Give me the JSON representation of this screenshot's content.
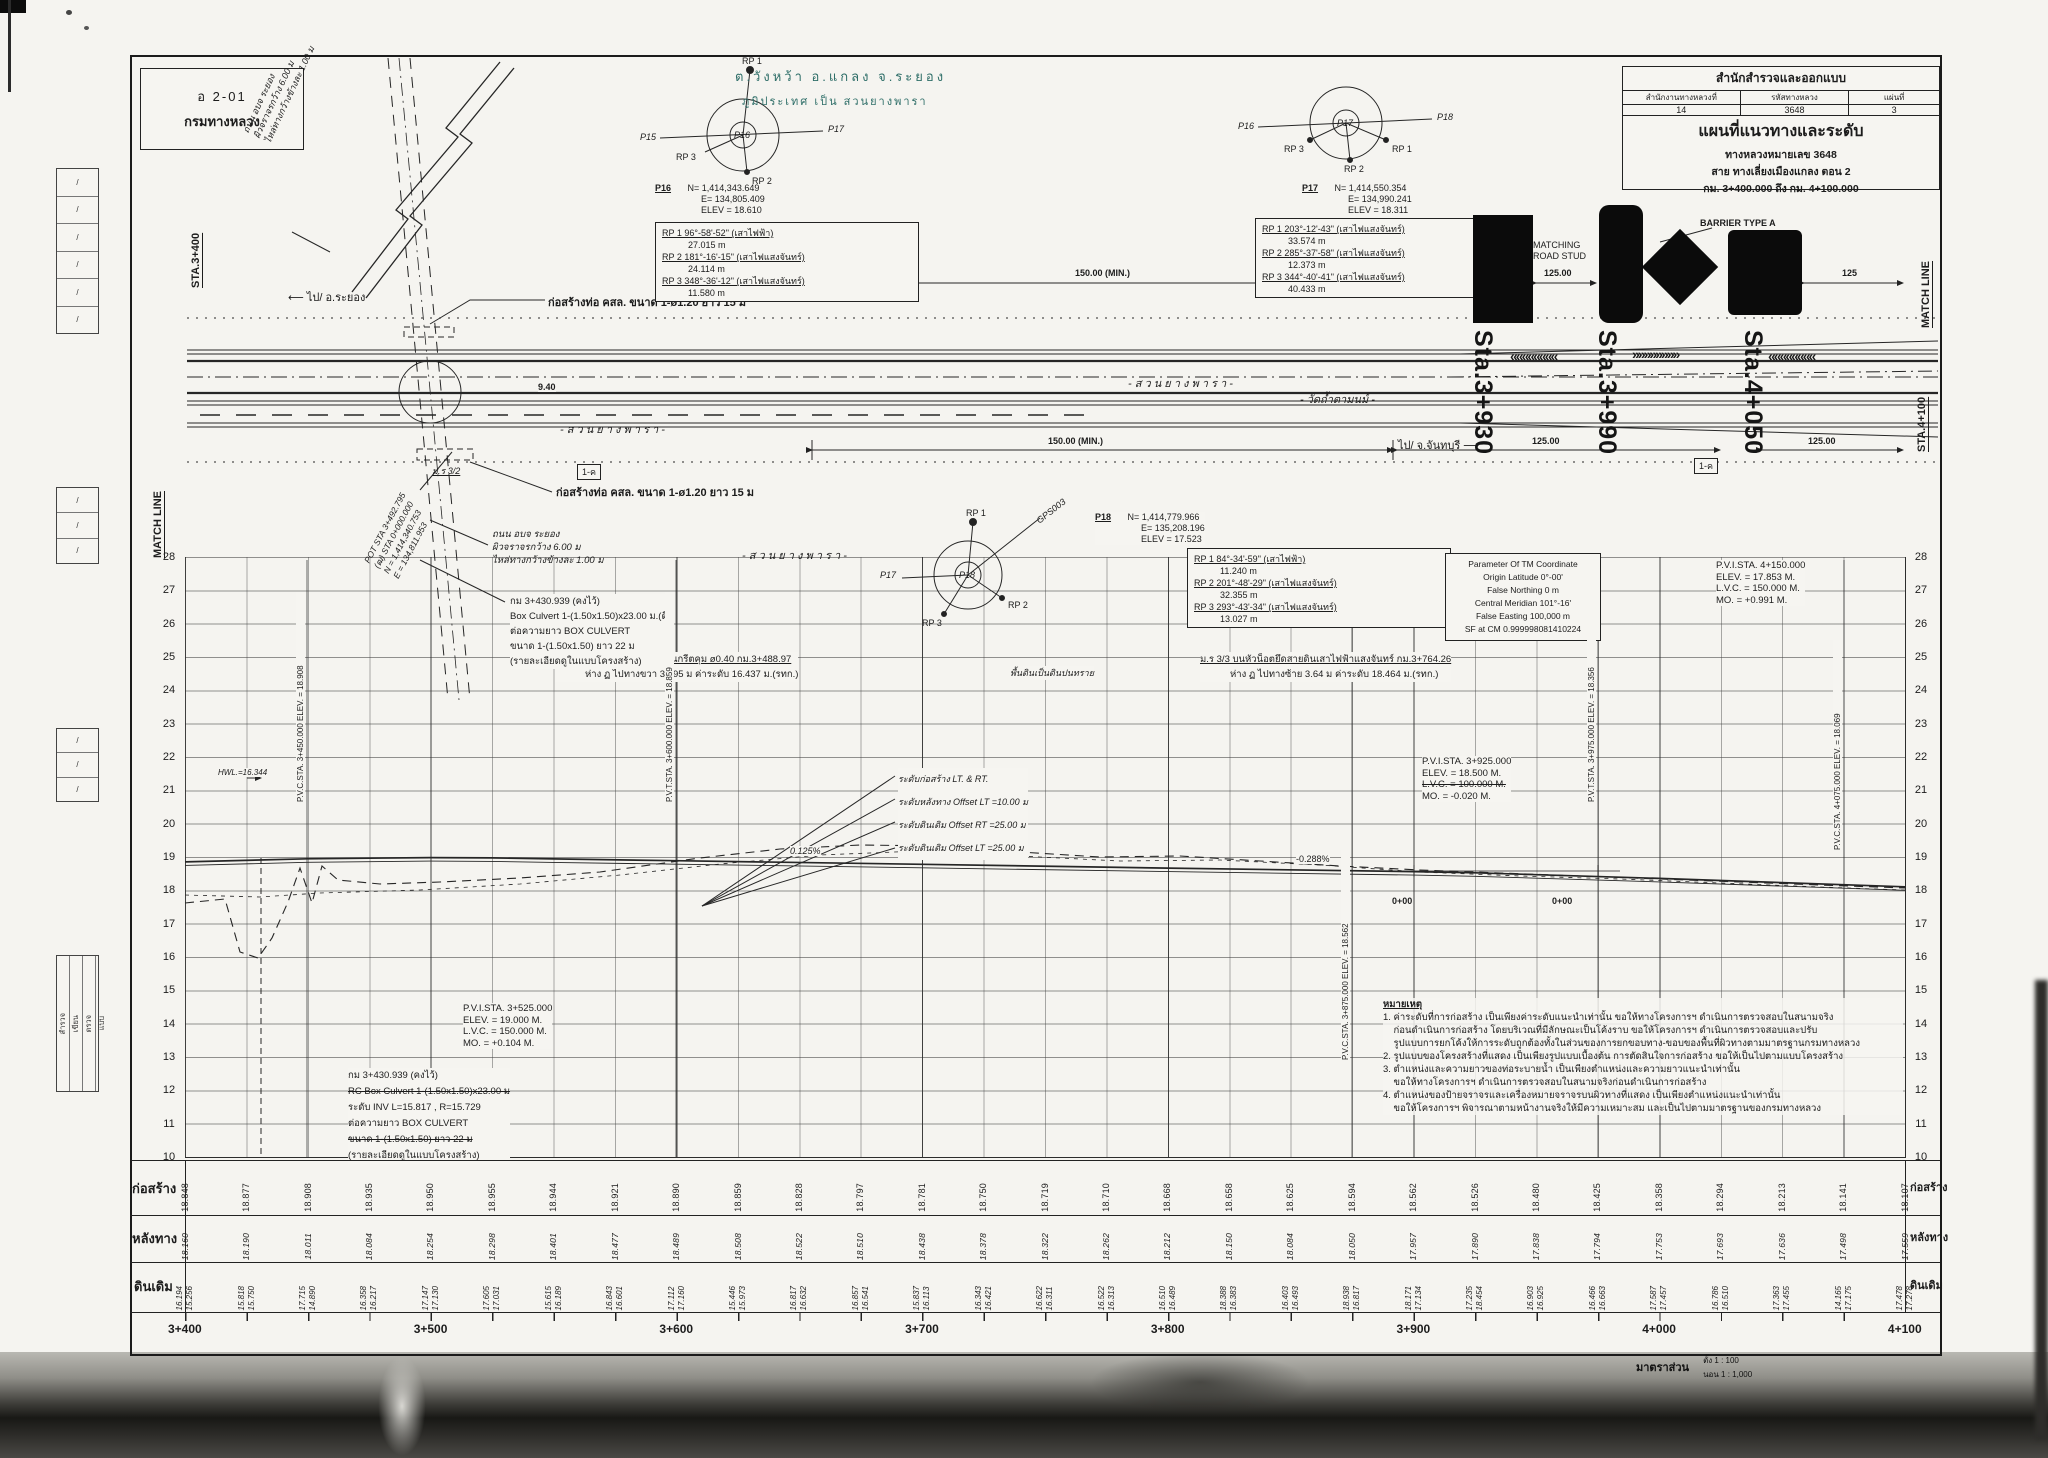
{
  "stamp": {
    "code": "อ 2-01",
    "org": "กรมทางหลวง"
  },
  "title_block": {
    "bureau": "สำนักสำรวจและออกแบบ",
    "col1": "สำนักงานทางหลวงที่",
    "col2": "รหัสทางหลวง",
    "col3": "แผ่นที่",
    "val1": "14",
    "val2": "3648",
    "val3": "3",
    "title": "แผนที่แนวทางและระดับ",
    "road": "ทางหลวงหมายเลข 3648",
    "section": "สาย ทางเลี่ยงเมืองแกลง ตอน 2",
    "km_range": "กม. 3+400.000 ถึง กม. 4+100.000"
  },
  "location": {
    "line1": "ต.วังหว้า อ.แกลง จ.ระยอง",
    "line2": "ภูมิประเทศ เป็น สวนยางพารา",
    "accent": "#2e6e68"
  },
  "plan": {
    "match_line_left": "MATCH LINE",
    "match_line_right": "MATCH LINE",
    "sta_left": "STA.3+400",
    "sta_right": "STA.4+100",
    "dir_left": "ไป/ อ.ระยอง",
    "dir_right": "ไป/ จ.จันทบุรี",
    "pipe_note_top": "ก่อสร้างท่อ คสล. ขนาด 1-ø1.20 ยาว 15 ม",
    "pipe_note_bottom": "ก่อสร้างท่อ คสล. ขนาด 1-ø1.20 ยาว 15 ม",
    "side_road_note": [
      "ถนน อบจ ระยอง",
      "ผิวจราจรกว้าง 6.00 ม",
      "ไหล่ทางกว้างข้างละ 1.00 ม"
    ],
    "side_road_note_rot": [
      "ถนน อบจ ระยอง",
      "ผิวจราจรกว้าง 6.00 ม",
      "ไหล่ทางกว้างข้างละ 1.00 ม"
    ],
    "pot_note": [
      "POT STA 3+492.795",
      "(ฒ) STA 0+000.000",
      "N = 1,414,340.753",
      "E = 134,811.953"
    ],
    "culvert_note": [
      "กม 3+430.939 (คงไว้)",
      "Box Culvert 1-(1.50x1.50)x23.00 ม.(ดี)",
      "ต่อความยาว BOX CULVERT",
      "ขนาด 1-(1.50x1.50) ยาว 22 ม",
      "(รายละเอียดดูในแบบโครงสร้าง)"
    ],
    "bm_label": "ม.ร 3/2",
    "sym1": "1-ค",
    "sym2": "1-ค",
    "dim_940": "9.40",
    "plantation1": "- ส ว น ย า ง พ า ร า -",
    "plantation2": "- ส ว น ย า ง พ า ร า -",
    "plantation3": "- ส ว น ย า ง พ า ร า -",
    "temple": "- วัดถ้ำตามนม์ -",
    "matching": "MATCHING",
    "road_stud": "ROAD STUD",
    "barrier": "BARRIER TYPE A",
    "dim_150_top": "150.00 (MIN.)",
    "dim_125_top": "125.00",
    "dim_125_right": "125",
    "dim_150_bot": "150.00 (MIN.)",
    "dim_125_bot1": "125.00",
    "dim_125_bot2": "125.00",
    "chevrons": [
      "««««««««",
      "»»»»»»»»",
      "««««««««"
    ],
    "sta_overlays": [
      "Sta.3+930",
      "Sta.3+990",
      "Sta.4+050"
    ]
  },
  "p16": {
    "id": "P16",
    "n": "N= 1,414,343.649",
    "e": "E=   134,805.409",
    "elev": "ELEV = 18.610",
    "lbl_left": "P15",
    "lbl_right": "P17",
    "rp1": "RP 1",
    "rp2": "RP 2",
    "rp3": "RP 3",
    "rps": [
      {
        "a": "RP 1 96°-58'-52\" (เสาไฟฟ้า)",
        "d": "27.015 m"
      },
      {
        "a": "RP 2 181°-16'-15\" (เสาไฟแสงจันทร์)",
        "d": "24.114 m"
      },
      {
        "a": "RP 3 348°-36'-12\" (เสาไฟแสงจันทร์)",
        "d": "11.580 m"
      }
    ]
  },
  "p17": {
    "id": "P17",
    "n": "N= 1,414,550.354",
    "e": "E=   134,990.241",
    "elev": "ELEV = 18.311",
    "lbl_left": "P16",
    "lbl_right": "P18",
    "rp1": "RP 1",
    "rp2": "RP 2",
    "rp3": "RP 3",
    "rps": [
      {
        "a": "RP 1 203°-12'-43\" (เสาไฟแสงจันทร์)",
        "d": "33.574 m"
      },
      {
        "a": "RP 2 285°-37'-58\" (เสาไฟแสงจันทร์)",
        "d": "12.373 m"
      },
      {
        "a": "RP 3 344°-40'-41\" (เสาไฟแสงจันทร์)",
        "d": "40.433 m"
      }
    ]
  },
  "p18": {
    "id": "P18",
    "n": "N= 1,414,779.966",
    "e": "E=   135,208.196",
    "elev": "ELEV = 17.523",
    "lbl_left": "P17",
    "gps": "GPS003",
    "rp1": "RP 1",
    "rp2": "RP 2",
    "rp3": "RP 3",
    "rps": [
      {
        "a": "RP 1 84°-34'-59\" (เสาไฟฟ้า)",
        "d": "11.240 m"
      },
      {
        "a": "RP 2 201°-48'-29\" (เสาไฟแสงจันทร์)",
        "d": "32.355 m"
      },
      {
        "a": "RP 3 293°-43'-34\" (เสาไฟแสงจันทร์)",
        "d": "13.027 m"
      }
    ]
  },
  "tm_parameters": [
    "Parameter Of TM Coordinate",
    "Origin Latitude  0°-00'",
    "False Northing  0 m",
    "Central Meridian  101°-16'",
    "False Easting  100,000 m",
    "SF at CM  0.999998081410224"
  ],
  "benchmarks": {
    "bm2_l1": "ม.ร 3/2 บนหัวน็อตสะพานคอนกรีตคุม ø0.40  กม.3+488.97",
    "bm2_l2": "ห่าง ฏ ไปทางขวา 38.95 ม  ค่าระดับ 16.437 ม.(รทก.)",
    "soil": "พื้นดินเป็นดินปนทราย",
    "bm3_l1": "ม.ร 3/3 บนหัวน็อตยึดสายดินเสาไฟฟ้าแสงจันทร์  กม.3+764.26",
    "bm3_l2": "ห่าง ฏ ไปทางซ้าย 3.64 ม  ค่าระดับ 18.464 ม.(รทก.)"
  },
  "profile": {
    "elevations": [
      "28",
      "27",
      "26",
      "25",
      "24",
      "23",
      "22",
      "21",
      "20",
      "19",
      "18",
      "17",
      "16",
      "15",
      "14",
      "13",
      "12",
      "11",
      "10"
    ],
    "pvi1": [
      "P.V.I.STA. 3+525.000",
      "ELEV.  =  19.000   M.",
      "L.V.C.  =  150.000   M.",
      "MO.     =  +0.104   M."
    ],
    "pvi2": [
      "P.V.I.STA. 3+925.000",
      "ELEV.  =  18.500   M.",
      "L.V.C.  =  100.000   M.",
      "MO.     =  -0.020   M."
    ],
    "pvi3": [
      "P.V.I.STA. 4+150.000",
      "ELEV.  =  17.853   M.",
      "L.V.C.  =  150.000   M.",
      "MO.     =  +0.991   M."
    ],
    "vlabels": [
      "P.V.C.STA. 3+450.000   ELEV. = 18.908",
      "P.V.T.STA. 3+600.000   ELEV. = 18.859",
      "P.V.C.STA. 3+875.000   ELEV. = 18.562",
      "P.V.T.STA. 3+975.000   ELEV. = 18.356",
      "P.V.C.STA. 4+075.000   ELEV. = 18.069"
    ],
    "grade1": "0.125%",
    "grade2": "-0.288%",
    "zero1": "0+00",
    "zero2": "0+00",
    "hwl": "HWL.=16.344",
    "offsets": [
      "ระดับก่อสร้าง LT. & RT.",
      "ระดับหลังทาง Offset LT =10.00 ม",
      "ระดับดินเดิม Offset RT =25.00 ม",
      "ระดับดินเดิม Offset LT =25.00 ม"
    ],
    "culvert_note": [
      {
        "txt": "กม 3+430.939 (คงไว้)",
        "strike": ""
      },
      {
        "txt": "RC Box Culvert 1-(1.50x1.50)x23.00 ม",
        "strike": "y"
      },
      {
        "txt": "ระดับ INV L=15.817 , R=15.729",
        "strike": ""
      },
      {
        "txt": "ต่อความยาว BOX CULVERT",
        "strike": ""
      },
      {
        "txt": "ขนาด 1-(1.50x1.50) ยาว 22 ม",
        "strike": "y"
      },
      {
        "txt": "(รายละเอียดดูในแบบโครงสร้าง)",
        "strike": ""
      }
    ]
  },
  "notes": {
    "heading": "หมายเหตุ",
    "lines": [
      "1. ค่าระดับที่การก่อสร้าง เป็นเพียงค่าระดับแนะนำเท่านั้น ขอให้ทางโครงการฯ ดำเนินการตรวจสอบในสนามจริง",
      "    ก่อนดำเนินการก่อสร้าง โดยบริเวณที่มีลักษณะเป็นโค้งราบ ขอให้โครงการฯ ดำเนินการตรวจสอบและปรับ",
      "    รูปแบบการยกโค้งให้การระดับถูกต้องทั้งในส่วนของการยกขอบทาง-ขอบของพื้นที่ผิวทางตามมาตรฐานกรมทางหลวง",
      "2. รูปแบบของโครงสร้างที่แสดง เป็นเพียงรูปแบบเบื้องต้น การตัดสินใจการก่อสร้าง ขอให้เป็นไปตามแบบโครงสร้าง",
      "3. ตำแหน่งและความยาวของท่อระบายน้ำ เป็นเพียงตำแหน่งและความยาวแนะนำเท่านั้น",
      "    ขอให้ทางโครงการฯ ดำเนินการตรวจสอบในสนามจริงก่อนดำเนินการก่อสร้าง",
      "4. ตำแหน่งของป้ายจราจรและเครื่องหมายจราจรบนผิวทางที่แสดง เป็นเพียงตำแหน่งแนะนำเท่านั้น",
      "    ขอให้โครงการฯ พิจารณาตามหน้างานจริงให้มีความเหมาะสม และเป็นไปตามมาตรฐานของกรมทางหลวง"
    ]
  },
  "rows": {
    "label_construction": "ก่อสร้าง",
    "label_back": "หลังทาง",
    "label_ground": "ดินเดิม",
    "construction": [
      "18.848",
      "18.877",
      "18.908",
      "18.935",
      "18.950",
      "18.955",
      "18.944",
      "18.921",
      "18.890",
      "18.859",
      "18.828",
      "18.797",
      "18.781",
      "18.750",
      "18.719",
      "18.710",
      "18.668",
      "18.658",
      "18.625",
      "18.594",
      "18.562",
      "18.526",
      "18.480",
      "18.425",
      "18.358",
      "18.294",
      "18.213",
      "18.141",
      "18.107"
    ],
    "back": [
      "18.160",
      "18.190",
      "18.011",
      "18.084",
      "18.254",
      "18.298",
      "18.401",
      "18.477",
      "18.489",
      "18.508",
      "18.522",
      "18.510",
      "18.438",
      "18.378",
      "18.322",
      "18.262",
      "18.212",
      "18.150",
      "18.084",
      "18.050",
      "17.957",
      "17.890",
      "17.838",
      "17.794",
      "17.753",
      "17.693",
      "17.636",
      "17.498",
      "17.559"
    ],
    "ground": [
      {
        "a": "16.194",
        "b": "15.256"
      },
      {
        "a": "15.818",
        "b": "15.750"
      },
      {
        "a": "17.715",
        "b": "14.890"
      },
      {
        "a": "16.358",
        "b": "16.217"
      },
      {
        "a": "17.147",
        "b": "17.130"
      },
      {
        "a": "17.605",
        "b": "17.031"
      },
      {
        "a": "15.615",
        "b": "16.189"
      },
      {
        "a": "16.843",
        "b": "16.601"
      },
      {
        "a": "17.112",
        "b": "17.160"
      },
      {
        "a": "15.446",
        "b": "15.973"
      },
      {
        "a": "16.817",
        "b": "16.632"
      },
      {
        "a": "16.857",
        "b": "16.541"
      },
      {
        "a": "15.837",
        "b": "16.113"
      },
      {
        "a": "16.343",
        "b": "16.421"
      },
      {
        "a": "16.622",
        "b": "16.311"
      },
      {
        "a": "16.522",
        "b": "16.313"
      },
      {
        "a": "16.510",
        "b": "16.489"
      },
      {
        "a": "18.388",
        "b": "16.383"
      },
      {
        "a": "16.403",
        "b": "16.493"
      },
      {
        "a": "18.938",
        "b": "16.817"
      },
      {
        "a": "18.171",
        "b": "17.134"
      },
      {
        "a": "17.235",
        "b": "18.454"
      },
      {
        "a": "16.903",
        "b": "16.925"
      },
      {
        "a": "16.466",
        "b": "16.663"
      },
      {
        "a": "17.587",
        "b": "17.457"
      },
      {
        "a": "16.786",
        "b": "16.510"
      },
      {
        "a": "17.363",
        "b": "17.455"
      },
      {
        "a": "14.165",
        "b": "17.175"
      },
      {
        "a": "17.478",
        "b": "17.278"
      }
    ],
    "stations": [
      "3+400",
      "3+500",
      "3+600",
      "3+700",
      "3+800",
      "3+900",
      "4+000",
      "4+100"
    ]
  },
  "scale": {
    "label": "มาตราส่วน",
    "v": "ตั้ง  1 : 100",
    "h": "นอน  1 : 1,000"
  },
  "margin": {
    "slashes": [
      "/",
      "/",
      "/",
      "/",
      "/",
      "/"
    ],
    "slashes2": [
      "/",
      "/",
      "/"
    ],
    "words": [
      "สำรวจ",
      "เขียน",
      "ตรวจ",
      "แบบ"
    ]
  },
  "chart_data": {
    "type": "line",
    "title": "Profile: elevation vs station (กม. 3+400 – 4+100)",
    "xlabel": "Station",
    "ylabel": "Elevation (m)",
    "ylim": [
      10,
      28
    ],
    "x": [
      "3+400",
      "3+425",
      "3+450",
      "3+475",
      "3+500",
      "3+525",
      "3+550",
      "3+575",
      "3+600",
      "3+625",
      "3+650",
      "3+675",
      "3+700",
      "3+725",
      "3+750",
      "3+775",
      "3+800",
      "3+825",
      "3+850",
      "3+875",
      "3+900",
      "3+925",
      "3+950",
      "3+975",
      "4+000",
      "4+025",
      "4+050",
      "4+075",
      "4+100"
    ],
    "series": [
      {
        "name": "ก่อสร้าง (design grade)",
        "values": [
          18.848,
          18.877,
          18.908,
          18.935,
          18.95,
          18.955,
          18.944,
          18.921,
          18.89,
          18.859,
          18.828,
          18.797,
          18.781,
          18.75,
          18.719,
          18.71,
          18.668,
          18.658,
          18.625,
          18.594,
          18.562,
          18.526,
          18.48,
          18.425,
          18.358,
          18.294,
          18.213,
          18.141,
          18.107
        ]
      },
      {
        "name": "หลังทาง (existing road)",
        "values": [
          18.16,
          18.19,
          18.011,
          18.084,
          18.254,
          18.298,
          18.401,
          18.477,
          18.489,
          18.508,
          18.522,
          18.51,
          18.438,
          18.378,
          18.322,
          18.262,
          18.212,
          18.15,
          18.084,
          18.05,
          17.957,
          17.89,
          17.838,
          17.794,
          17.753,
          17.693,
          17.636,
          17.498,
          17.559
        ]
      },
      {
        "name": "ดินเดิม (original ground)",
        "values": [
          16.194,
          15.818,
          17.715,
          16.358,
          17.147,
          17.605,
          15.615,
          16.843,
          17.112,
          15.446,
          16.817,
          16.857,
          15.837,
          16.343,
          16.622,
          16.522,
          16.51,
          18.388,
          16.403,
          18.938,
          18.171,
          17.235,
          16.903,
          16.466,
          17.587,
          16.786,
          17.363,
          14.165,
          17.478
        ]
      }
    ]
  }
}
